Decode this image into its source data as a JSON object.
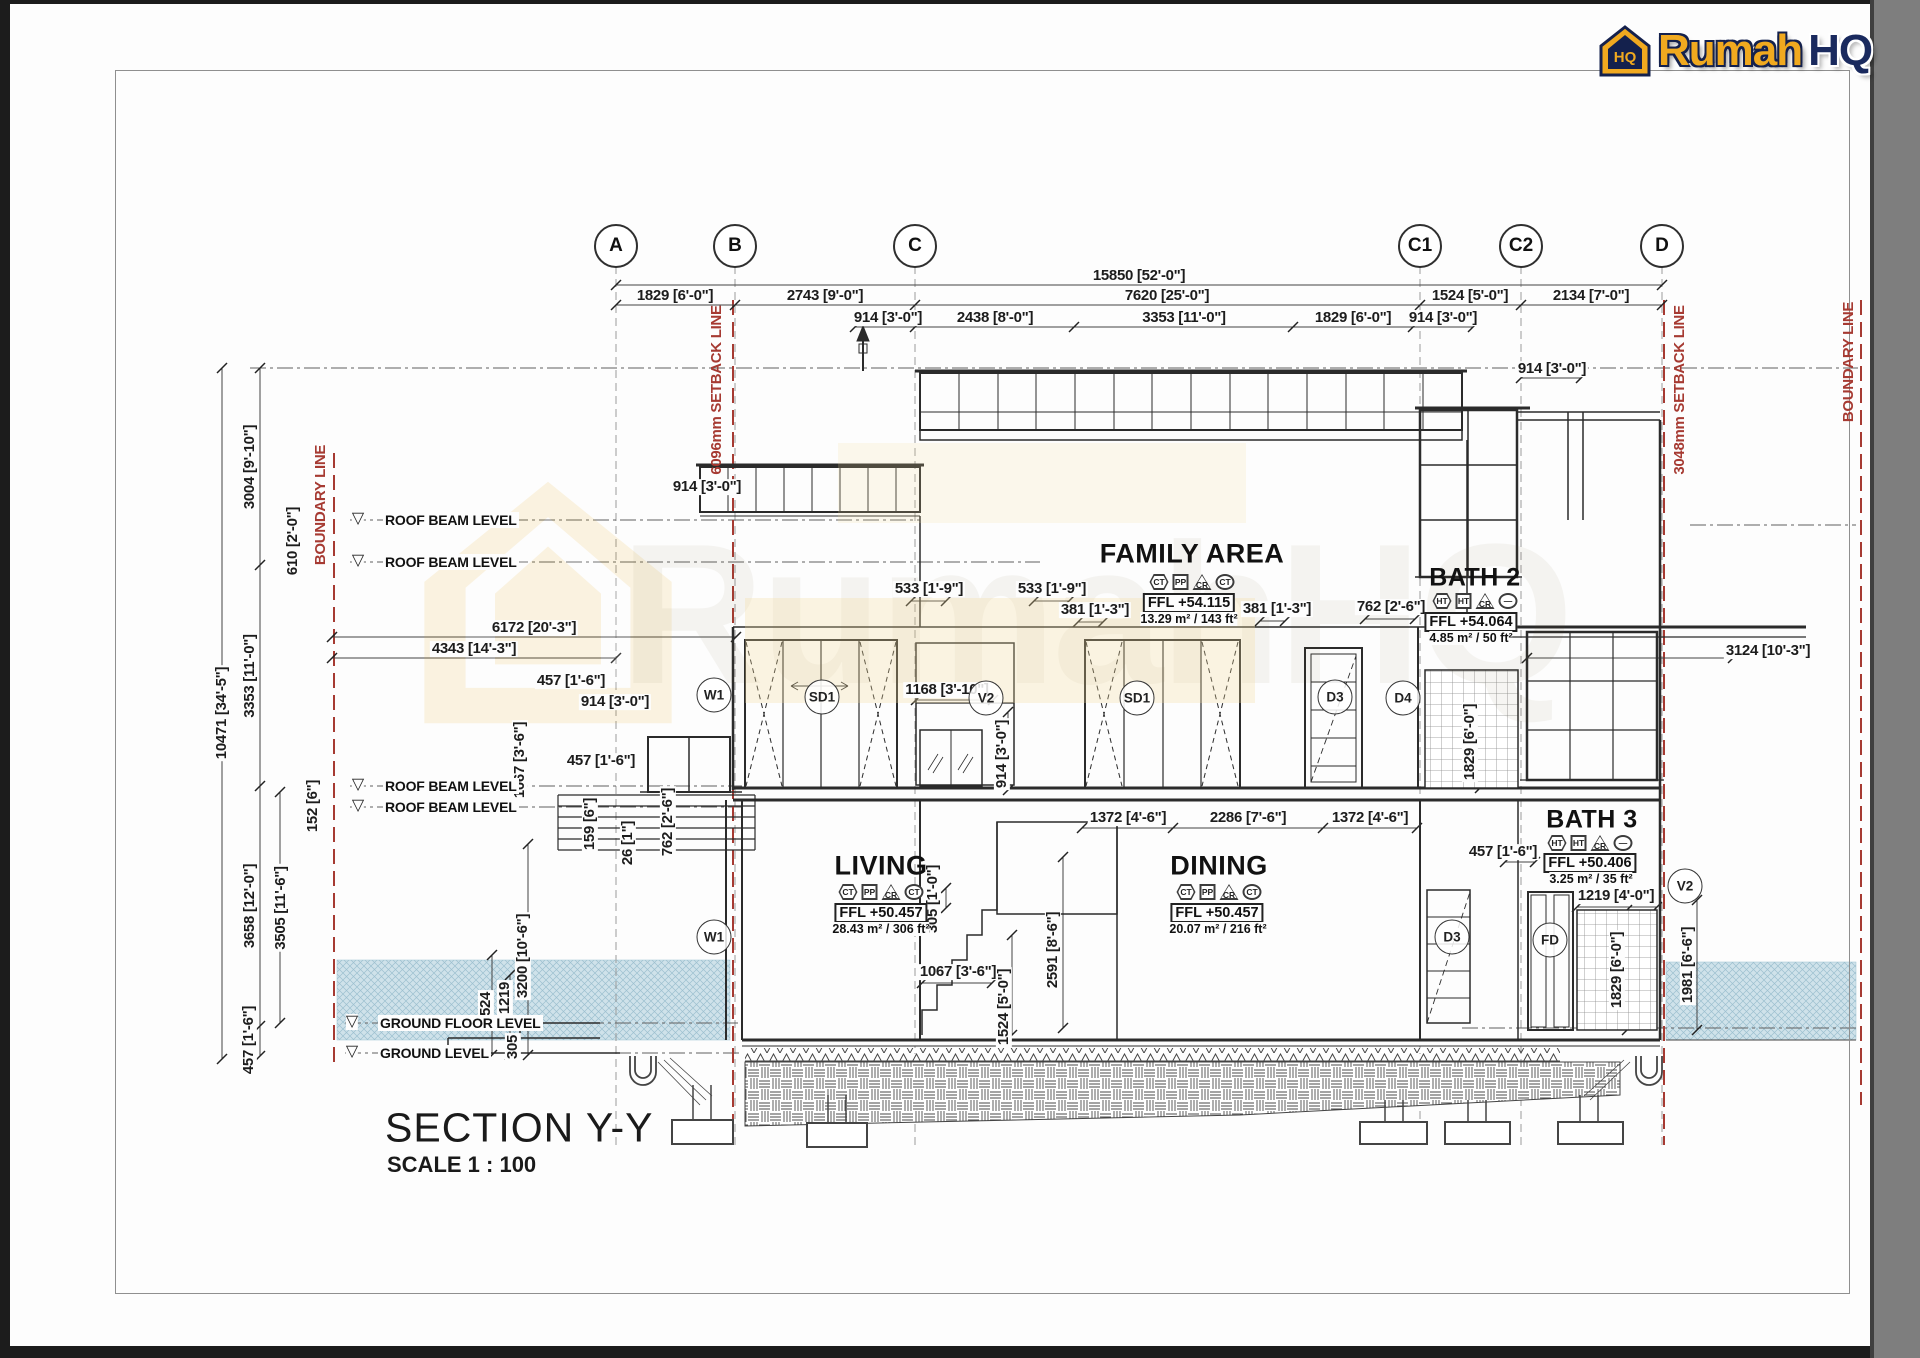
{
  "page": {
    "title": "SECTION Y-Y",
    "scale": "SCALE 1 : 100"
  },
  "logo": {
    "brand": "Rumah",
    "suffix": "HQ"
  },
  "grid": {
    "labels": [
      "A",
      "B",
      "C",
      "C1",
      "C2",
      "D"
    ]
  },
  "site": {
    "boundary_left": "BOUNDARY LINE",
    "setback_left": "6096mm SETBACK LINE",
    "setback_right": "3048mm SETBACK LINE",
    "boundary_right": "BOUNDARY LINE",
    "line_color": "#A63A32"
  },
  "levels": {
    "roof_beam": "ROOF BEAM LEVEL",
    "ground_floor": "GROUND FLOOR LEVEL",
    "ground": "GROUND LEVEL"
  },
  "rooms": {
    "family": {
      "name": "FAMILY AREA",
      "ffl": "FFL +54.115",
      "area": "13.29 m² / 143 ft²",
      "tags": [
        "CT",
        "PP",
        "CR",
        "CT"
      ]
    },
    "bath2": {
      "name": "BATH 2",
      "ffl": "FFL +54.064",
      "area": "4.85 m² / 50 ft²",
      "tags": [
        "HT",
        "HT",
        "CR",
        "—"
      ]
    },
    "living": {
      "name": "LIVING",
      "ffl": "FFL +50.457",
      "area": "28.43 m² / 306 ft²",
      "tags": [
        "CT",
        "PP",
        "CR",
        "CT"
      ]
    },
    "dining": {
      "name": "DINING",
      "ffl": "FFL +50.457",
      "area": "20.07 m² / 216 ft²",
      "tags": [
        "CT",
        "PP",
        "CR",
        "CT"
      ]
    },
    "bath3": {
      "name": "BATH 3",
      "ffl": "FFL +50.406",
      "area": "3.25 m² / 35 ft²",
      "tags": [
        "HT",
        "HT",
        "CR",
        "—"
      ]
    }
  },
  "tags": {
    "w1": "W1",
    "sd1": "SD1",
    "v2": "V2",
    "d3": "D3",
    "d4": "D4",
    "fd": "FD"
  },
  "dims": {
    "d15850": "15850 [52'-0\"]",
    "d1829": "1829 [6'-0\"]",
    "d2743": "2743 [9'-0\"]",
    "d7620": "7620 [25'-0\"]",
    "d1524": "1524 [5'-0\"]",
    "d2134": "2134 [7'-0\"]",
    "d914": "914 [3'-0\"]",
    "d2438": "2438 [8'-0\"]",
    "d3353": "3353 [11'-0\"]",
    "d3004": "3004 [9'-10\"]",
    "d610": "610 [2'-0\"]",
    "d6172": "6172 [20'-3\"]",
    "d4343": "4343 [14'-3\"]",
    "d457": "457 [1'-6\"]",
    "d10471": "10471 [34'-5\"]",
    "d152": "152 [6\"]",
    "d3658": "3658 [12'-0\"]",
    "d3505": "3505 [11'-6\"]",
    "d159": "159 [6\"]",
    "d26": "26 [1\"]",
    "d762": "762 [2'-6\"]",
    "d3200": "3200 [10'-6\"]",
    "d1524p": "1524",
    "d1219p": "1219",
    "d305p": "305",
    "d533": "533 [1'-9\"]",
    "d381": "381 [1'-3\"]",
    "d1168": "1168 [3'-10\"]",
    "d3124": "3124 [10'-3\"]",
    "d305": "305 [1'-0\"]",
    "d1067": "1067 [3'-6\"]",
    "d2591": "2591 [8'-6\"]",
    "d1372": "1372 [4'-6\"]",
    "d2286": "2286 [7'-6\"]",
    "d1219": "1219 [4'-0\"]",
    "d1981": "1981 [6'-6\"]"
  }
}
